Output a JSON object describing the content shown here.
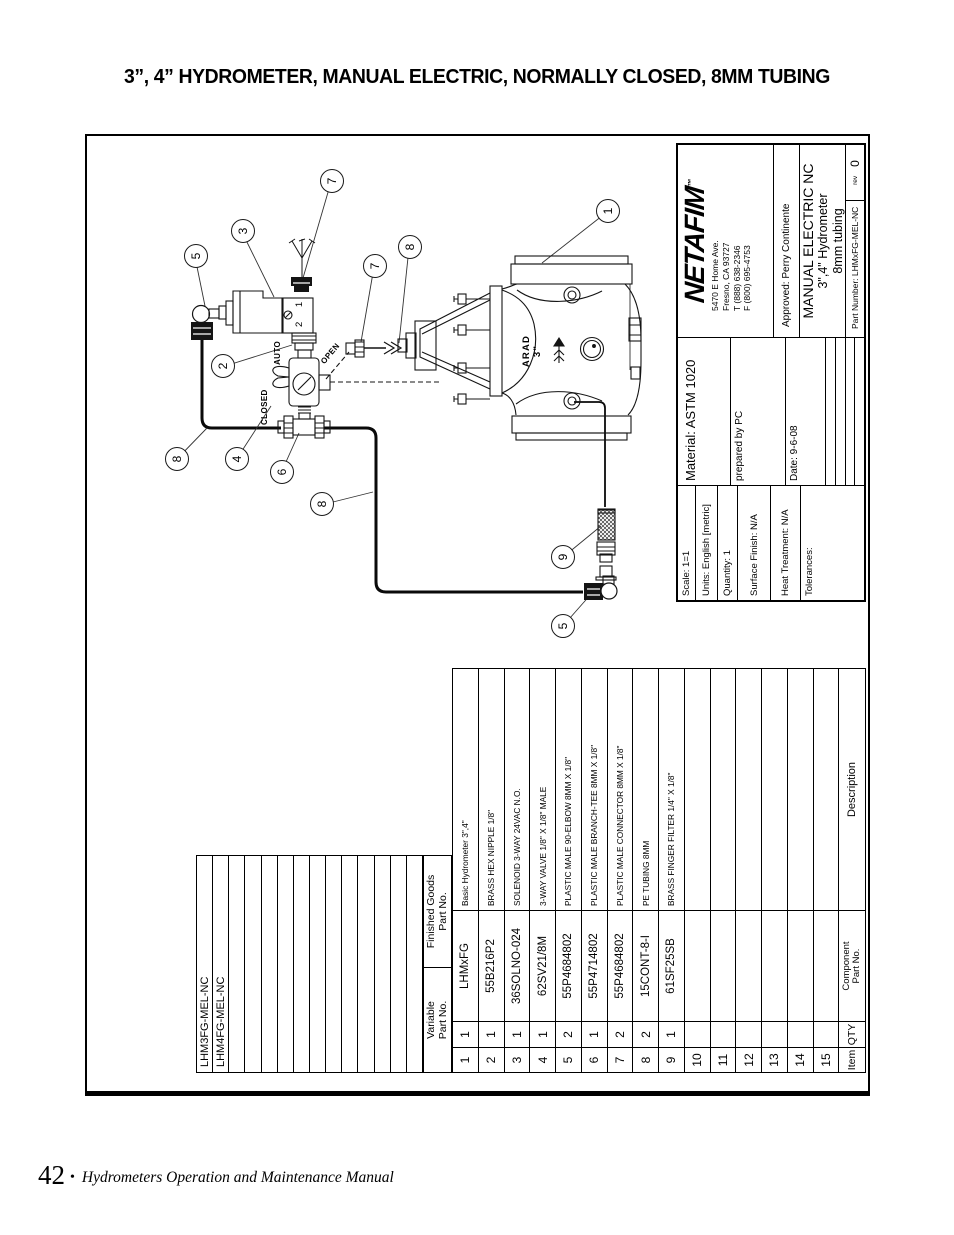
{
  "page": {
    "title": "3”, 4” HYDROMETER, MANUAL ELECTRIC, NORMALLY CLOSED, 8MM TUBING"
  },
  "footer": {
    "page_number": "42",
    "separator": "•",
    "manual_title": "Hydrometers Operation and Maintenance Manual"
  },
  "title_block": {
    "logo": "NETAFIM",
    "logo_tm": "™",
    "address_lines": [
      "5470 E Home Ave.",
      "Fresno, CA 93727",
      "T (888) 638-2346",
      "F (800) 695-4753"
    ],
    "approved": "Approved: Perry Continente",
    "title_line1": "MANUAL ELECTRIC NC",
    "title_line2": "3\",4\" Hydrometer",
    "title_line3": "8mm tubing",
    "part_number": "Part Number: LHMxFG-MEL-NC",
    "rev_label": "rev",
    "rev_value": "0",
    "material": "Material:  ASTM 1020",
    "prepared_by": "prepared by PC",
    "date": "Date: 9-6-08",
    "scale": "Scale:  1=1",
    "units": "Units: English [metric]",
    "quantity": "Quantity:  1",
    "surface_finish": "Surface Finish: N/A",
    "heat_treatment": "Heat Treatment: N/A",
    "tolerances": "Tolerances:"
  },
  "bom": {
    "finished_goods": [
      "LHM3FG-MEL-NC",
      "LHM4FG-MEL-NC"
    ],
    "headers": {
      "variable_1": "Variable",
      "variable_2": "Part No.",
      "finished_1": "Finished Goods",
      "finished_2": "Part No.",
      "item": "Item",
      "qty": "QTY",
      "component_1": "Component",
      "component_2": "Part No.",
      "description": "Description"
    },
    "rows": [
      {
        "item": "1",
        "qty": "1",
        "part": "LHMxFG",
        "desc": "Basic Hydrometer 3\",4\""
      },
      {
        "item": "2",
        "qty": "1",
        "part": "55B216P2",
        "desc": "BRASS HEX NIPPLE 1/8\""
      },
      {
        "item": "3",
        "qty": "1",
        "part": "36SOLNO-024",
        "desc": "SOLENOID 3-WAY 24VAC N.O."
      },
      {
        "item": "4",
        "qty": "1",
        "part": "62SV21/8M",
        "desc": "3-WAY VALVE 1/8\" X 1/8\" MALE"
      },
      {
        "item": "5",
        "qty": "2",
        "part": "55P4684802",
        "desc": "PLASTIC MALE 90-ELBOW 8MM X 1/8\""
      },
      {
        "item": "6",
        "qty": "1",
        "part": "55P4714802",
        "desc": "PLASTIC MALE BRANCH-TEE 8MM X 1/8\""
      },
      {
        "item": "7",
        "qty": "2",
        "part": "55P4684802",
        "desc": "PLASTIC MALE CONNECTOR 8MM X 1/8\""
      },
      {
        "item": "8",
        "qty": "2",
        "part": "15CONT-8-I",
        "desc": "PE TUBING 8MM"
      },
      {
        "item": "9",
        "qty": "1",
        "part": "61SF25SB",
        "desc": "BRASS FINGER FILTER 1/4\" X 1/8\""
      },
      {
        "item": "10",
        "qty": "",
        "part": "",
        "desc": ""
      },
      {
        "item": "11",
        "qty": "",
        "part": "",
        "desc": ""
      },
      {
        "item": "12",
        "qty": "",
        "part": "",
        "desc": ""
      },
      {
        "item": "13",
        "qty": "",
        "part": "",
        "desc": ""
      },
      {
        "item": "14",
        "qty": "",
        "part": "",
        "desc": ""
      },
      {
        "item": "15",
        "qty": "",
        "part": "",
        "desc": ""
      }
    ]
  },
  "diagram": {
    "balloons": [
      "1",
      "2",
      "3",
      "4",
      "5",
      "5",
      "6",
      "7",
      "7",
      "8",
      "8",
      "8",
      "9"
    ],
    "labels": {
      "auto": "AUTO",
      "open": "OPEN",
      "closed": "CLOSED",
      "ports": "2 1",
      "brand": "ARAD",
      "size": "3\""
    }
  }
}
